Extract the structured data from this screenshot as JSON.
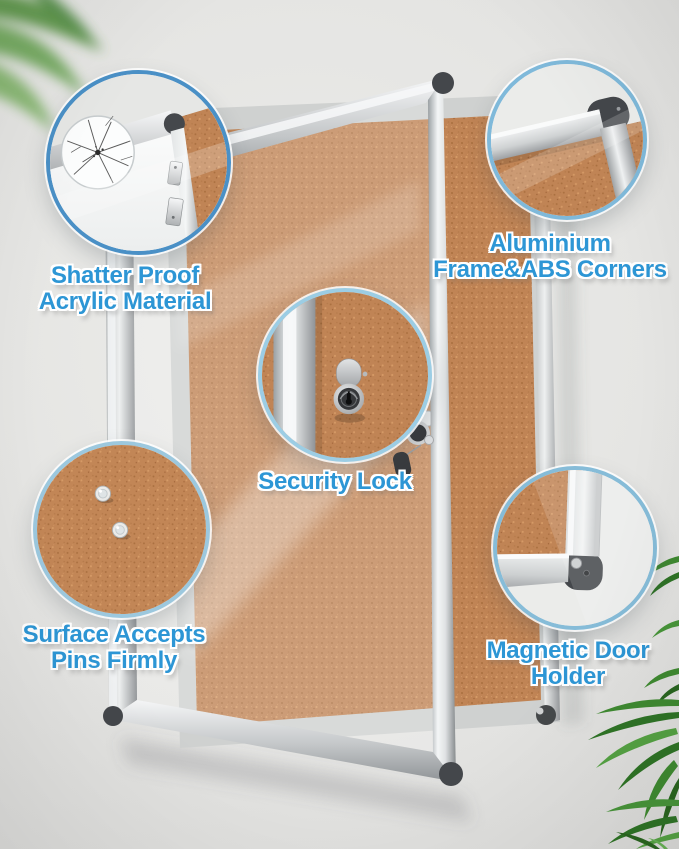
{
  "callouts": {
    "shatter_proof": {
      "line1": "Shatter Proof",
      "line2": "Acrylic Material"
    },
    "aluminium_frame": {
      "line1": "Aluminium",
      "line2": "Frame&ABS Corners"
    },
    "security_lock": {
      "line1": "Security Lock"
    },
    "pin_surface": {
      "line1": "Surface Accepts",
      "line2": "Pins Firmly"
    },
    "magnetic_door_holder": {
      "line1": "Magnetic Door",
      "line2": "Holder"
    }
  },
  "colors": {
    "label_text": "#2d96d5",
    "label_outline": "#ffffff",
    "callout_ring_primary": "#4a90c6",
    "callout_ring_light": "#8fc3de",
    "cork": "#c08455",
    "aluminium_frame": "#c9cbcd",
    "abs_corner": "#44474b",
    "wall": "#e2e2e0",
    "leaf_green": "#3f8a31"
  }
}
